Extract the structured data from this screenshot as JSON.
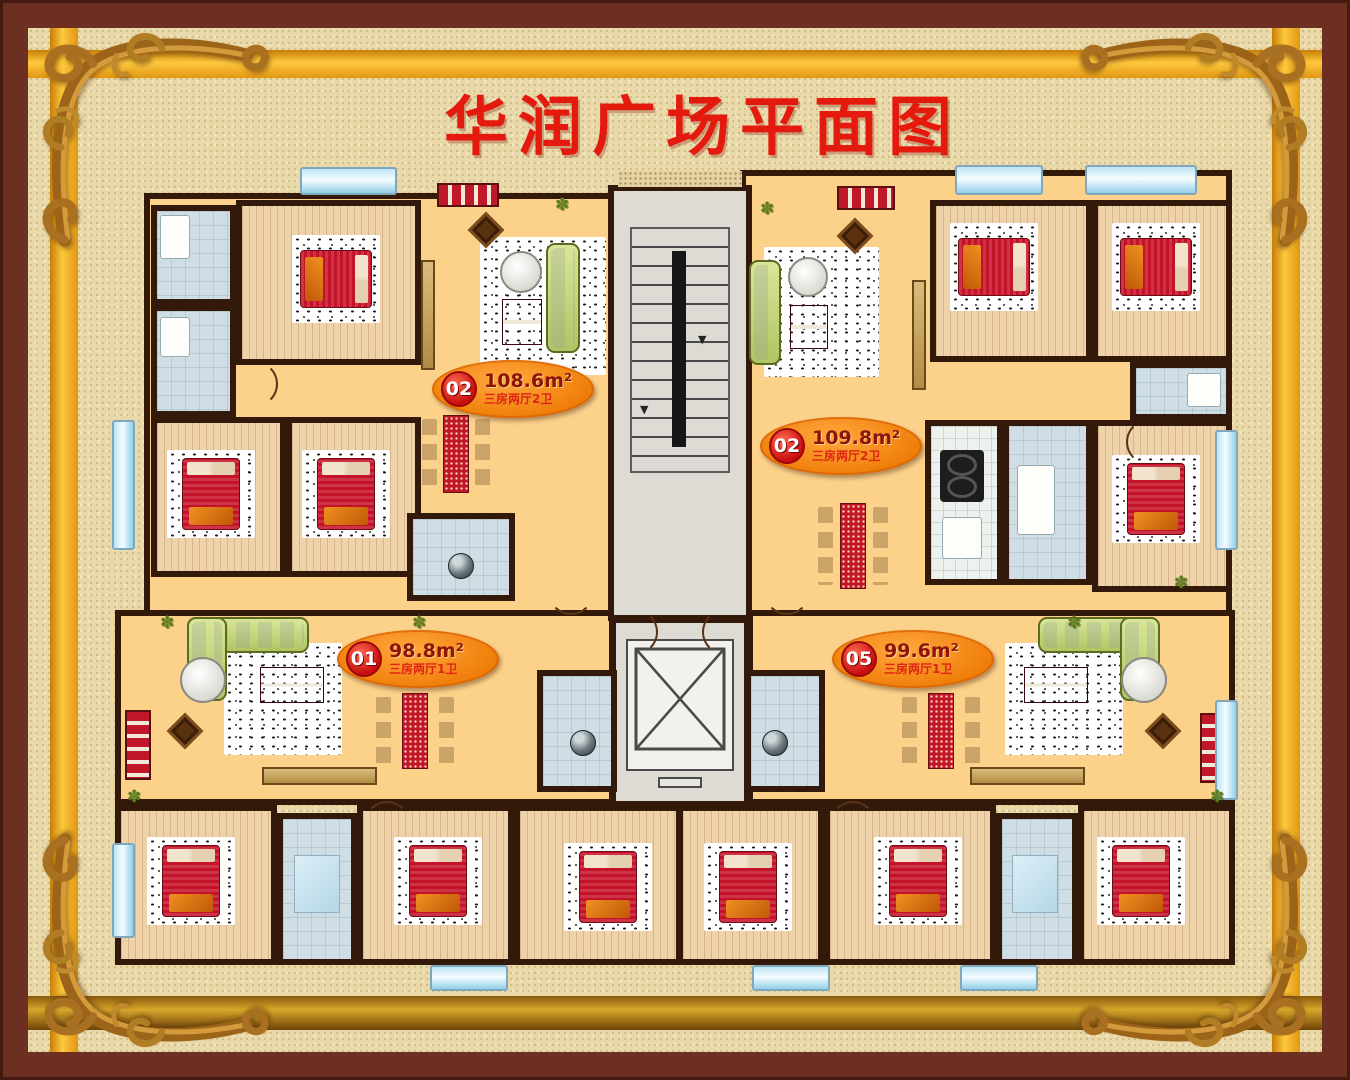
{
  "title": "华润广场平面图",
  "units": [
    {
      "code": "02",
      "area": "108.6m²",
      "layout": "三房两厅2卫"
    },
    {
      "code": "02",
      "area": "109.8m²",
      "layout": "三房两厅2卫"
    },
    {
      "code": "01",
      "area": "98.8m²",
      "layout": "三房两厅1卫"
    },
    {
      "code": "05",
      "area": "99.6m²",
      "layout": "三房两厅1卫"
    }
  ],
  "colors": {
    "frame": "#6e2f23",
    "background": "#ead9a8",
    "gold_band": "#e0a41e",
    "wall": "#33190a",
    "floor": "#fcd28b",
    "badge_orange": "#f08312",
    "accent_red": "#e41a0e"
  }
}
